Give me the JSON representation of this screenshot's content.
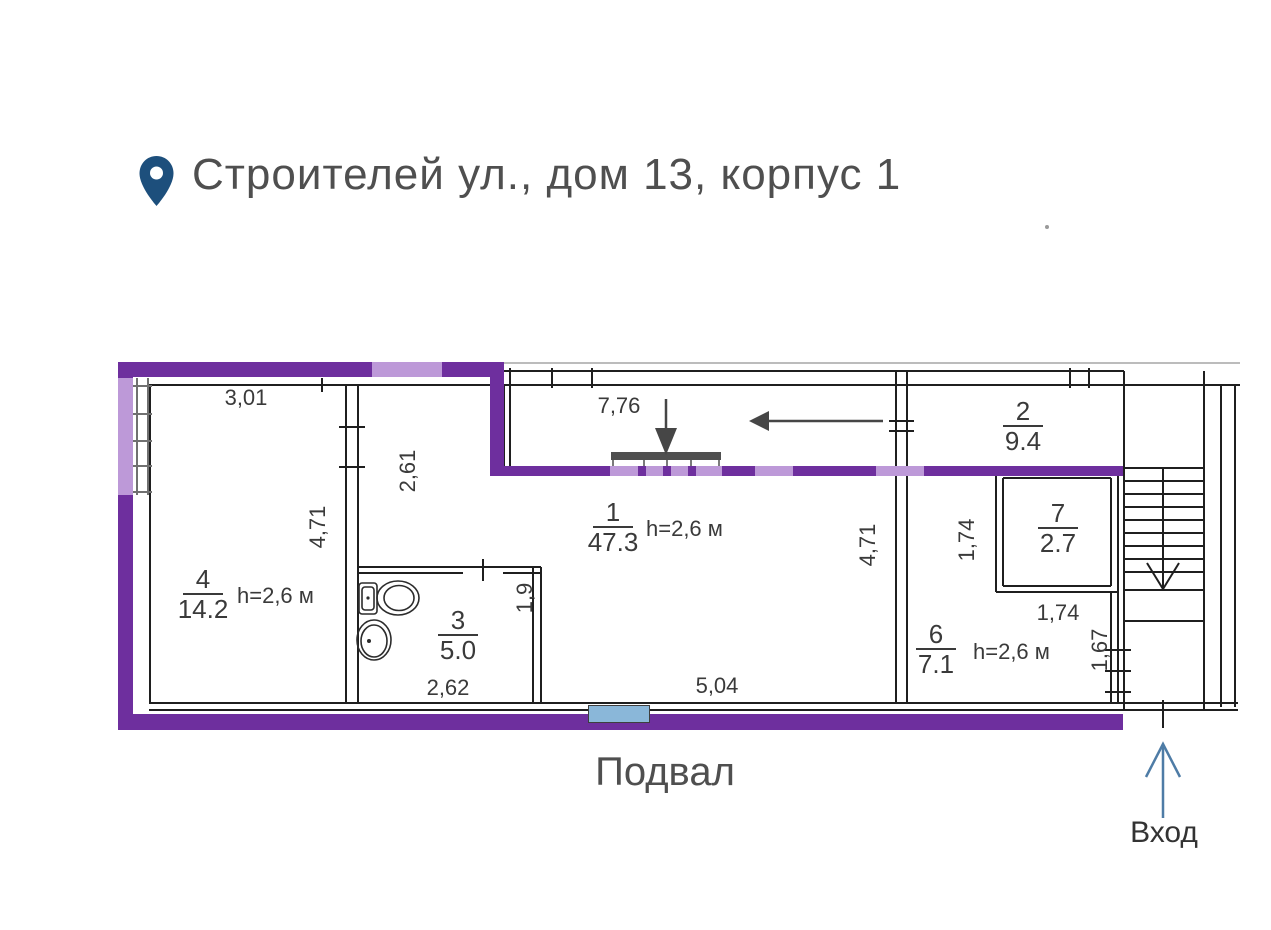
{
  "header": {
    "title": "Строителей ул., дом 13, корпус 1"
  },
  "plan": {
    "floor_label": "Подвал",
    "entrance_label": "Вход",
    "rooms": {
      "r4": {
        "num": "4",
        "area": "14.2",
        "h": "h=2,6 м"
      },
      "r1": {
        "num": "1",
        "area": "47.3",
        "h": "h=2,6 м"
      },
      "r3": {
        "num": "3",
        "area": "5.0"
      },
      "r2": {
        "num": "2",
        "area": "9.4"
      },
      "r7": {
        "num": "7",
        "area": "2.7"
      },
      "r6": {
        "num": "6",
        "area": "7.1",
        "h": "h=2,6 м"
      }
    },
    "dims": {
      "room4_top": "3,01",
      "room4_side": "4,71",
      "nook_height": "2,61",
      "corridor_top": "7,76",
      "bath_side": "1,9",
      "bath_bottom": "2,62",
      "room1_bottom": "5,04",
      "room1_side": "4,71",
      "room7_side": "1,74",
      "room7_bottom": "1,74",
      "room6_side": "1,67"
    },
    "icons": {
      "location_pin": "location-pin",
      "flow_arrow_down": "arrow-down",
      "flow_arrow_left": "arrow-left",
      "stairs_arrow": "arrow-down",
      "entrance_arrow": "arrow-up",
      "toilet": "toilet",
      "sink": "sink",
      "stairs": "staircase",
      "radiator": "wall-vent",
      "basement_window": "window"
    },
    "colors": {
      "outline_dark_purple": "#6e2f9e",
      "outline_light_purple": "#bd99d8",
      "window_blue": "#8ab7d9",
      "entrance_arrow_blue": "#4e7ca6",
      "pin_blue": "#1d4f7c",
      "wall_black": "#1f1f1f",
      "text_gray": "#3a3a3a"
    }
  }
}
